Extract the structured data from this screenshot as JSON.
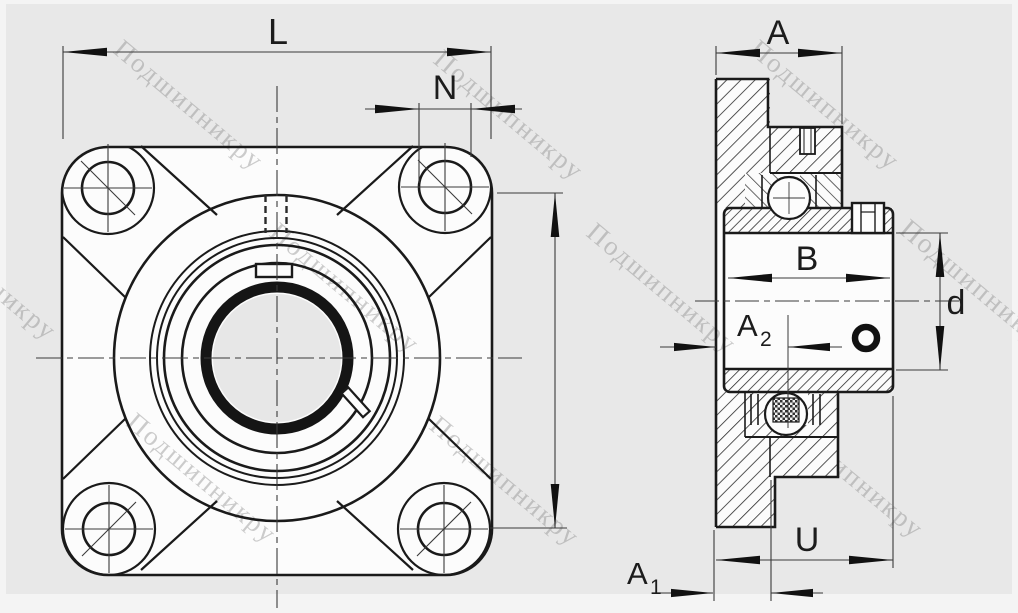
{
  "drawing": {
    "type": "bearing-unit-technical-drawing",
    "views": [
      "front-view-square-flange",
      "side-section-view"
    ]
  },
  "dims": {
    "L": "L",
    "N": "N",
    "A": "A",
    "B": "B",
    "d": "d",
    "U": "U",
    "A1": {
      "base": "A",
      "sub": "1"
    },
    "A2": {
      "base": "A",
      "sub": "2"
    }
  },
  "watermark": {
    "text": "Подшипникру"
  },
  "colors": {
    "background": "#e8e8e8",
    "paper_margin": "#f4f4f4",
    "line": "#1a1a1a",
    "thin_line": "#3a3a3a",
    "fill_white": "#fcfcfc",
    "bore_gray": "#e7e7e7",
    "watermark_gray": "#828282"
  }
}
